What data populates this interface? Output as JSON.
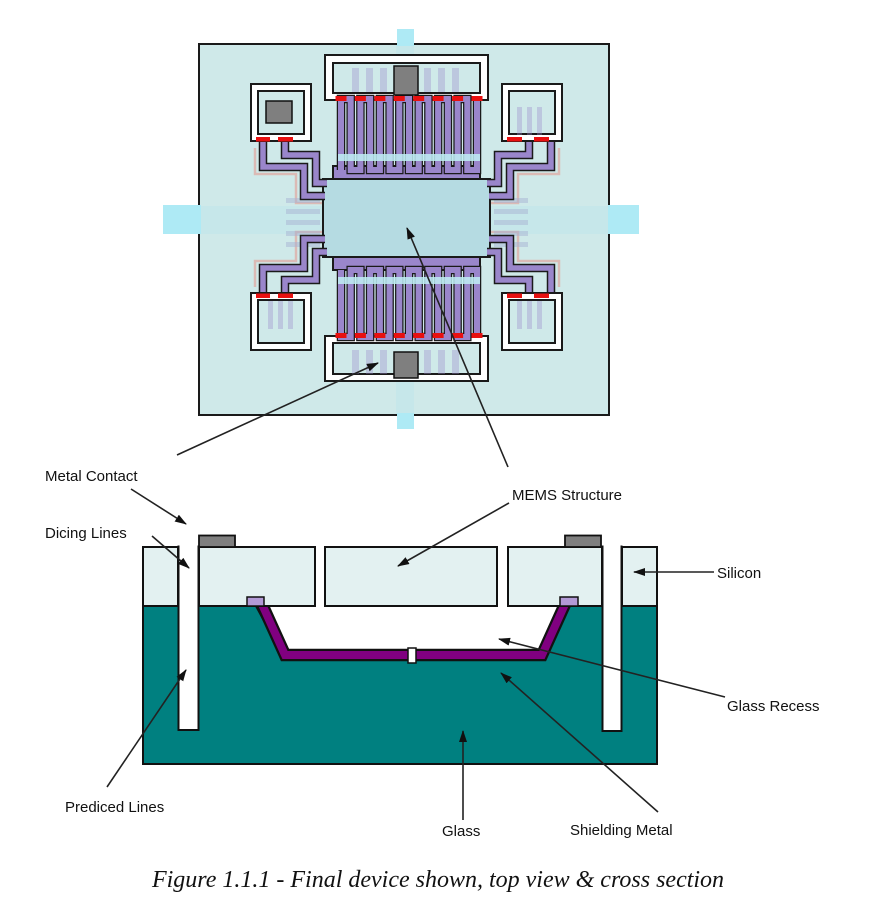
{
  "figure": {
    "caption": "Figure 1.1.1 - Final device shown, top view & cross section"
  },
  "labels": {
    "metal_contact": "Metal Contact",
    "dicing_lines": "Dicing Lines",
    "mems_structure": "MEMS Structure",
    "silicon": "Silicon",
    "glass_recess": "Glass Recess",
    "prediced_lines": "Prediced Lines",
    "glass": "Glass",
    "shielding_metal": "Shielding Metal"
  },
  "colors": {
    "silicon": "#e3f1f1",
    "glass": "#008080",
    "shielding_metal": "#800080",
    "mems_structure_purple": "#9a86cb",
    "proof_mass": "#b5dbe2",
    "metal_contact_gray": "#7f7f7f",
    "junction_red": "#e81010",
    "die_background": "#cfe9e9",
    "cross_arm_blue": "#aeeaf5",
    "anchor_lavender": "#b39ad6"
  }
}
